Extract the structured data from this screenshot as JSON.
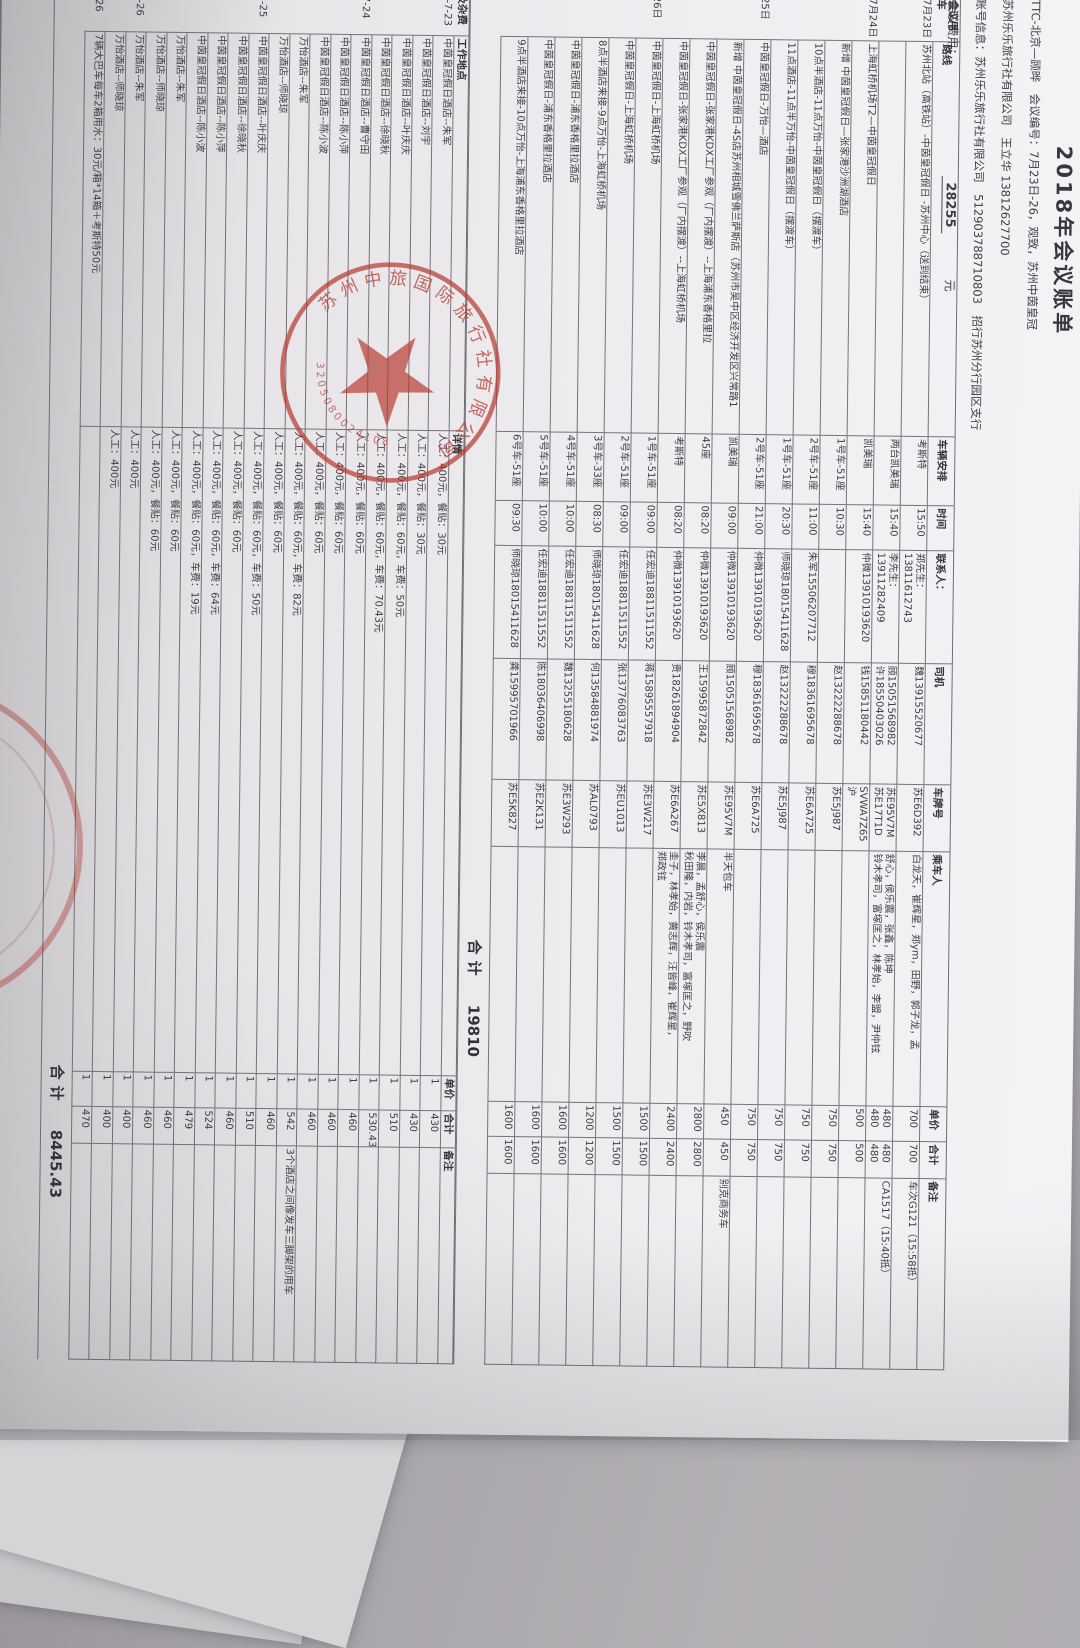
{
  "header": {
    "title": "2018年会议账单",
    "line1": "TTC-北京—顾晔　会议编号：7月23日-26，观致，苏州中茵皇冠",
    "line2": "苏州乐乐旅行社有限公司　王立华 13812627700",
    "line3": "账号信息：苏州乐乐旅行社有限公司　512903788710803　招行苏州分行园区支行",
    "fee_label": "会议费用：",
    "fee_value": "28255",
    "fee_unit": "元"
  },
  "main_table": {
    "section_label": "会议用车",
    "headers": [
      "路线",
      "车辆安排",
      "时间",
      "联系人：",
      "司机",
      "车牌号",
      "乘车人",
      "单价",
      "合计",
      "备注"
    ],
    "rows": [
      {
        "date": "7月23日",
        "route": "苏州北站（高铁站）-中茵皇冠假日 -苏州中心（送到结束）",
        "vehicle": "考斯特",
        "time": "15:50",
        "contact": "郑先生：13811612743",
        "driver": "魏13915520677",
        "plate": "苏E6D392",
        "passengers": "白龙天，崔辉星，郑ym，田野，郭子龙，孟",
        "price": "700",
        "total": "700",
        "note": "车次G121（15:58抵）"
      },
      {
        "date": "",
        "route": "",
        "vehicle": "两台凯美瑞",
        "time": "15:40",
        "contact": "李先生：13911282409",
        "driver": "顾15051568982\n许18550403026",
        "plate": "苏E95V7M\n苏E17T1D",
        "passengers": "舒心，侯乐震，张鑫，陈坤\n铃木孝司，富塚匡之，林孝始，李盟，尹仲铉",
        "price": "480\n480",
        "total": "480\n480",
        "note": "CA1517（15:40抵）"
      },
      {
        "date": "7月24日",
        "route": "上海虹桥机场T2—中茵皇冠假日",
        "vehicle": "凯美瑞",
        "time": "15:40",
        "contact": "仲微13910193620",
        "driver": "钱15851180442",
        "plate": "SVWA7Z65\n沪",
        "passengers": "",
        "price": "500",
        "total": "500",
        "note": ""
      },
      {
        "date": "",
        "route": "新增 中茵皇冠假日—张家港沙洲湖酒店",
        "vehicle": "1号车-51座",
        "time": "10:30",
        "contact": "",
        "driver": "赵13222288678",
        "plate": "苏E5J987",
        "passengers": "",
        "price": "750",
        "total": "750",
        "note": ""
      },
      {
        "date": "",
        "route": "10点半酒店-11点万怡-中茵皇冠假日（摆渡车）",
        "vehicle": "2号车-51座",
        "time": "11:00",
        "contact": "朱军15506207712",
        "driver": "穆18361695678",
        "plate": "苏E6A725",
        "passengers": "",
        "price": "750",
        "total": "750",
        "note": ""
      },
      {
        "date": "",
        "route": "11点酒店-11点半万怡-中茵皇冠假日（摆渡车）",
        "vehicle": "1号车-51座",
        "time": "20:30",
        "contact": "师晓琼18015411628",
        "driver": "赵13222288678",
        "plate": "苏E5J987",
        "passengers": "",
        "price": "750",
        "total": "750",
        "note": ""
      },
      {
        "date": "25日",
        "route": "中茵皇冠假日-万怡—酒店",
        "vehicle": "2号车-51座",
        "time": "21:00",
        "contact": "仲微13910193620",
        "driver": "穆18361695678",
        "plate": "苏E6A725",
        "passengers": "",
        "price": "750",
        "total": "750",
        "note": ""
      },
      {
        "date": "",
        "route": "新增 中茵皇冠假日-4S店苏州相城雪佛兰萨斯店（苏州市吴中区经济开发区兴常路1",
        "vehicle": "凯美瑞",
        "time": "09:00",
        "contact": "仲微13910193620",
        "driver": "顾15051568982",
        "plate": "苏E95V7M",
        "passengers": "半天包车",
        "price": "450",
        "total": "450",
        "note": "别克商务车"
      },
      {
        "date": "",
        "route": "中茵皇冠假日-张家港KDX工厂参观（厂内摆渡）--上海浦东香格里拉",
        "vehicle": "45座",
        "time": "08:20",
        "contact": "仲微13910193620",
        "driver": "王15995872842",
        "plate": "苏E5X813",
        "passengers": "李晨，孟舒心，侯乐震\n秋田隆，内岩，铃木孝司，富塚匡之，野吹",
        "price": "2800",
        "total": "2800",
        "note": ""
      },
      {
        "date": "",
        "route": "中茵皇冠假日-张家港KDX工厂参观（厂内摆渡）--上海虹桥机场",
        "vehicle": "考斯特",
        "time": "08:20",
        "contact": "仲微13910193620",
        "driver": "贵18261894904",
        "plate": "苏E6A267",
        "passengers": "圭子，林孝始，黄志辉，汪皆峰，崔辉星，\n郑政铉",
        "price": "2400",
        "total": "2400",
        "note": ""
      },
      {
        "date": "26日",
        "route": "中茵皇冠假日-上海虹桥机场",
        "vehicle": "1号车-51座",
        "time": "09:00",
        "contact": "任宏迪18811511552",
        "driver": "蒋15895557918",
        "plate": "苏E3W217",
        "passengers": "",
        "price": "1500",
        "total": "1500",
        "note": ""
      },
      {
        "date": "",
        "route": "中茵皇冠假日-上海虹桥机场",
        "vehicle": "2号车-51座",
        "time": "09:00",
        "contact": "任宏迪18811511552",
        "driver": "张13776083763",
        "plate": "苏EU1013",
        "passengers": "",
        "price": "1500",
        "total": "1500",
        "note": ""
      },
      {
        "date": "",
        "route": "8点半酒店来接-9点万怡-上海虹桥机场",
        "vehicle": "3号车-33座",
        "time": "08:30",
        "contact": "师晓琼18015411628",
        "driver": "何13584881974",
        "plate": "苏AL0793",
        "passengers": "",
        "price": "1200",
        "total": "1200",
        "note": ""
      },
      {
        "date": "",
        "route": "中茵皇冠假日-浦东香格里拉酒店",
        "vehicle": "4号车-51座",
        "time": "10:00",
        "contact": "任宏迪18811511552",
        "driver": "魏13255180628",
        "plate": "苏E3W293",
        "passengers": "",
        "price": "1600",
        "total": "1600",
        "note": ""
      },
      {
        "date": "",
        "route": "中茵皇冠假日-浦东香格里拉酒店",
        "vehicle": "5号车-51座",
        "time": "10:00",
        "contact": "任宏迪18811511552",
        "driver": "陈18036406998",
        "plate": "苏E2K131",
        "passengers": "",
        "price": "1600",
        "total": "1600",
        "note": ""
      },
      {
        "date": "",
        "route": "9点半酒店来接-10点万怡-上海浦东香格里拉酒店",
        "vehicle": "6号车-51座",
        "time": "09:30",
        "contact": "师晓琼18015411628",
        "driver": "龚15995701966",
        "plate": "苏E5K827",
        "passengers": "",
        "price": "1600",
        "total": "1600",
        "note": ""
      }
    ],
    "total_label": "合计",
    "total_value": "19810"
  },
  "misc_table": {
    "section_label": "及杂费",
    "headers": [
      "工作地点",
      "详情",
      "单价",
      "合计",
      "备注"
    ],
    "rows": [
      {
        "date": "8-7-23",
        "place": "中茵皇冠假日酒店--朱军",
        "detail": "人工：400元，餐贴：30元",
        "qty": "1",
        "total": "430",
        "note": ""
      },
      {
        "date": "",
        "place": "中茵皇冠假日酒店--刘宇",
        "detail": "人工：400元，餐贴：30元",
        "qty": "1",
        "total": "430",
        "note": ""
      },
      {
        "date": "",
        "place": "中茵皇冠假日酒店--叶庆庆",
        "detail": "人工：400元，餐贴：60元，车费：50元",
        "qty": "1",
        "total": "510",
        "note": ""
      },
      {
        "date": "",
        "place": "中茵皇冠假日酒店--徐晓秋",
        "detail": "人工：400元，餐贴：60元，车费：70.43元",
        "qty": "1",
        "total": "530.43",
        "note": ""
      },
      {
        "date": "-7-24",
        "place": "中茵皇冠假日酒店--曹守田",
        "detail": "人工：400元，餐贴：60元",
        "qty": "1",
        "total": "460",
        "note": ""
      },
      {
        "date": "",
        "place": "中茵皇冠假日酒店--陈小萍",
        "detail": "人工：400元，餐贴：60元",
        "qty": "1",
        "total": "460",
        "note": ""
      },
      {
        "date": "",
        "place": "中茵皇冠假日酒店--陈小波",
        "detail": "人工：400元，餐贴：60元",
        "qty": "1",
        "total": "460",
        "note": ""
      },
      {
        "date": "",
        "place": "万怡酒店--朱军",
        "detail": "人工：400元，餐贴：60元，车费：82元",
        "qty": "1",
        "total": "542",
        "note": "3个酒店之间像发车三脚架的用车"
      },
      {
        "date": "",
        "place": "万怡酒店--师晓琼",
        "detail": "人工：400元，餐贴：60元",
        "qty": "1",
        "total": "460",
        "note": ""
      },
      {
        "date": "-7-25",
        "place": "中茵皇冠假日酒店--叶庆庆",
        "detail": "人工：400元，餐贴：60元，车费：50元",
        "qty": "1",
        "total": "510",
        "note": ""
      },
      {
        "date": "",
        "place": "中茵皇冠假日酒店--徐晓秋",
        "detail": "人工：400元，餐贴：60元",
        "qty": "1",
        "total": "460",
        "note": ""
      },
      {
        "date": "",
        "place": "中茵皇冠假日酒店--陈小萍",
        "detail": "人工：400元，餐贴：60元，车费：64元",
        "qty": "1",
        "total": "524",
        "note": ""
      },
      {
        "date": "",
        "place": "中茵皇冠假日酒店--陈小波",
        "detail": "人工：400元，餐贴：60元，车费：19元",
        "qty": "1",
        "total": "479",
        "note": ""
      },
      {
        "date": "",
        "place": "万怡酒店--朱军",
        "detail": "人工：400元，餐贴：60元",
        "qty": "1",
        "total": "460",
        "note": ""
      },
      {
        "date": "",
        "place": "万怡酒店--师晓琼",
        "detail": "人工：400元，餐贴：60元",
        "qty": "1",
        "total": "460",
        "note": ""
      },
      {
        "date": "-7-26",
        "place": "万怡酒店--朱军",
        "detail": "人工：400元",
        "qty": "1",
        "total": "400",
        "note": ""
      },
      {
        "date": "",
        "place": "万怡酒店--师晓琼",
        "detail": "人工：400元",
        "qty": "1",
        "total": "400",
        "note": ""
      },
      {
        "date": "7-26",
        "place": "7辆大巴车每车2箱用水：30元/箱*14箱＋考斯特50元",
        "detail": "",
        "qty": "1",
        "total": "470",
        "note": ""
      }
    ],
    "total_label": "合计",
    "total_value": "8445.43"
  },
  "stamp": {
    "ring_text": "苏州中旅国际旅行社有限公司",
    "serial": "3205080024108"
  }
}
